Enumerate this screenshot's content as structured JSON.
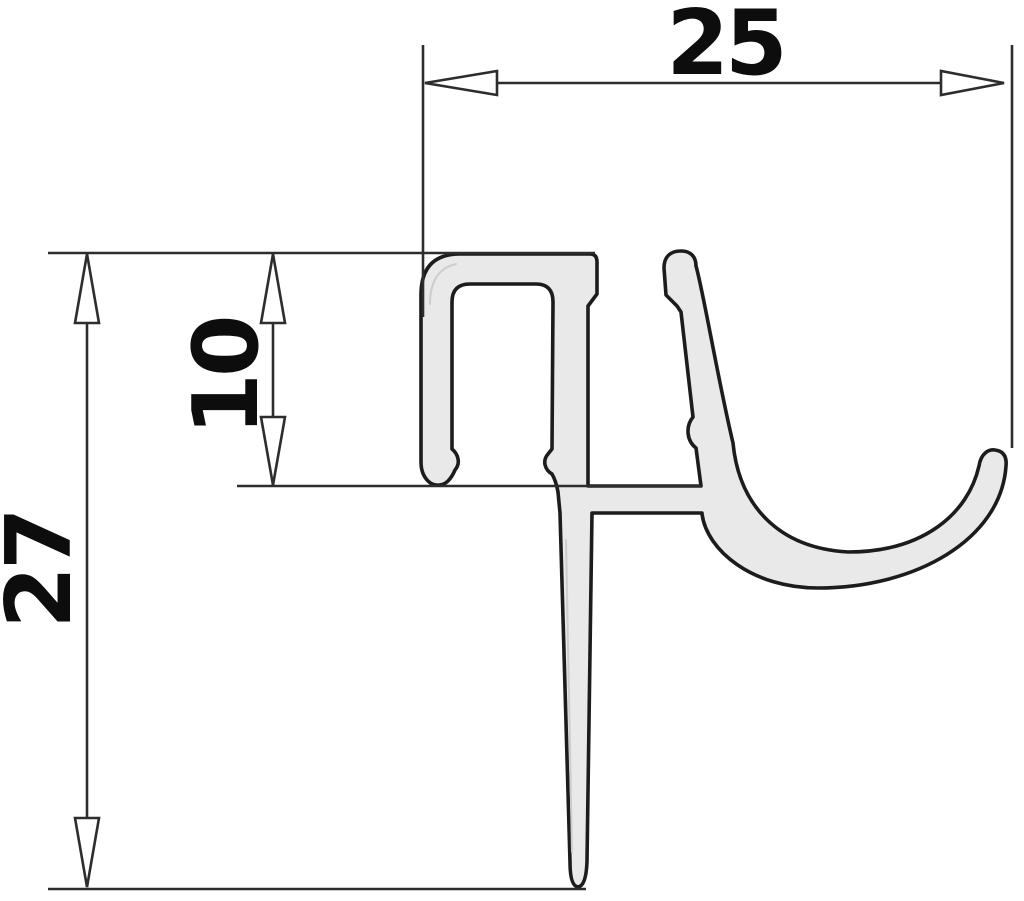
{
  "drawing": {
    "kind": "technical cross-section drawing",
    "subject": "shower seal extrusion profile",
    "background_color": "#ffffff",
    "profile": {
      "fill": "#e9e9e9",
      "outline": "#1c1c1c",
      "highlight": "#cdcdcd"
    },
    "dimension_color": "#2d2d2d",
    "text_color": "#0d0d0d",
    "arrow_fill": "#ffffff",
    "dimensions": [
      {
        "id": "overall-width",
        "label": "25",
        "orientation": "horizontal",
        "unit": "mm"
      },
      {
        "id": "channel-depth",
        "label": "10",
        "orientation": "vertical",
        "unit": "mm"
      },
      {
        "id": "overall-height",
        "label": "27",
        "orientation": "vertical",
        "unit": "mm"
      }
    ]
  }
}
